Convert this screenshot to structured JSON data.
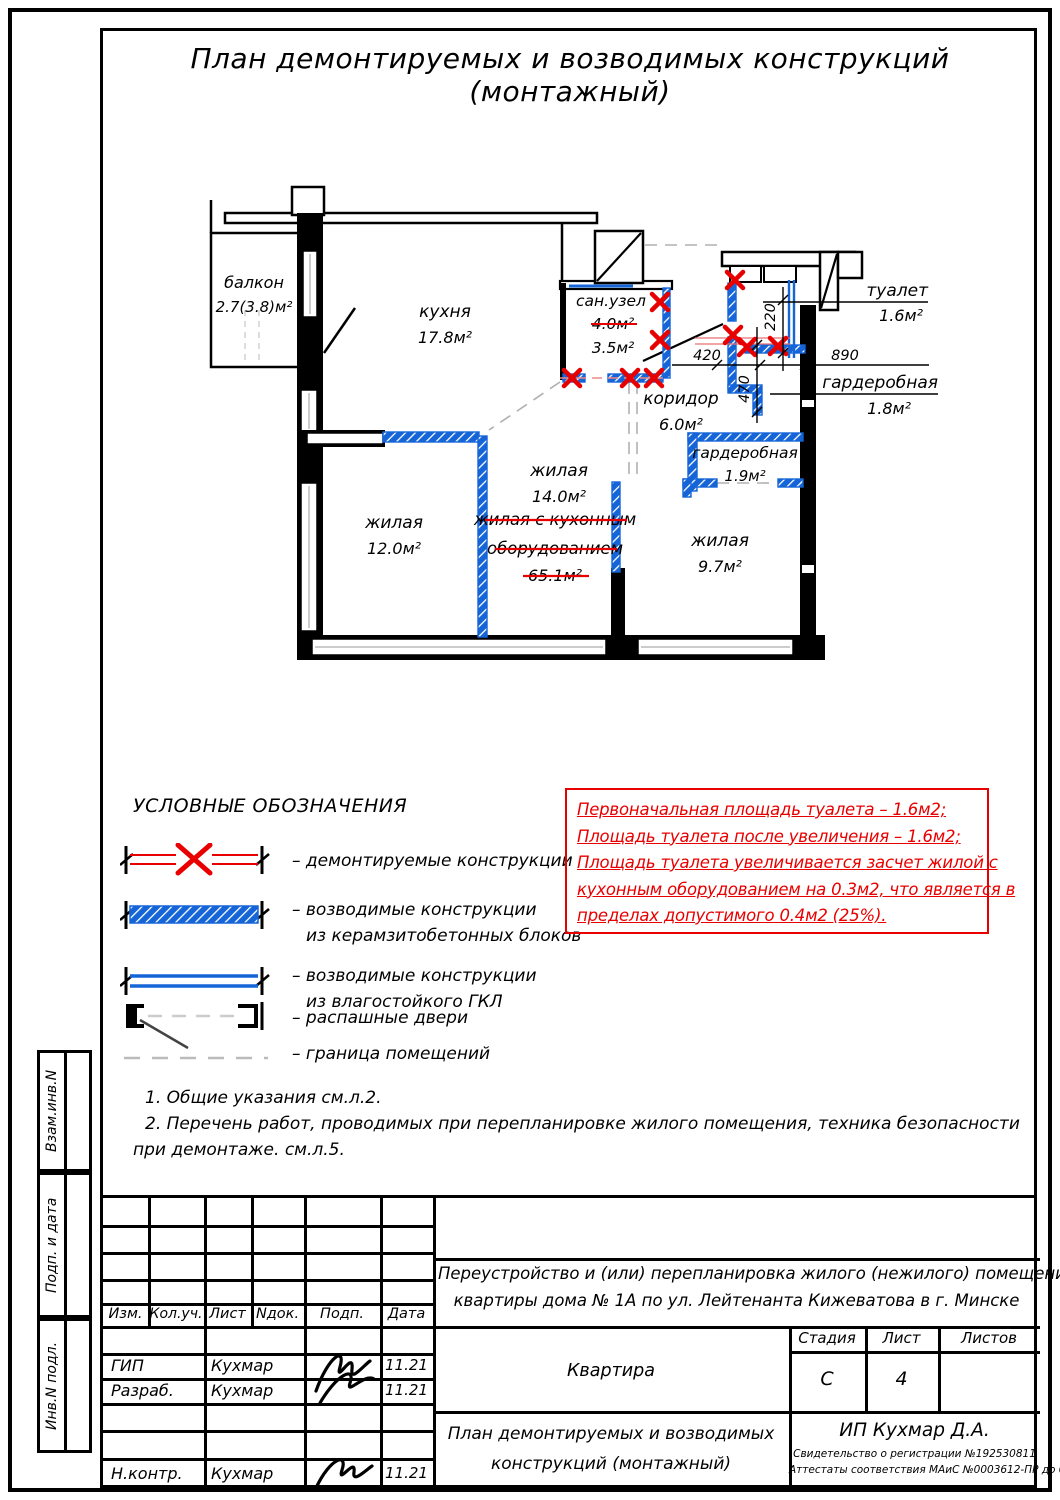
{
  "sheet_title": "План демонтируемых и возводимых конструкций (монтажный)",
  "plan": {
    "rooms": {
      "balcony": {
        "name": "балкон",
        "area": "2.7(3.8)м²"
      },
      "kitchen": {
        "name": "кухня",
        "area": "17.8м²"
      },
      "sanuzel": {
        "name": "сан.узел",
        "area_old": "4.0м²",
        "area_new": "3.5м²"
      },
      "corridor": {
        "name": "коридор",
        "area": "6.0м²"
      },
      "toilet": {
        "name": "туалет",
        "area": "1.6м²"
      },
      "wardrobe1": {
        "name": "гардеробная",
        "area": "1.8м²"
      },
      "wardrobe2": {
        "name": "гардеробная",
        "area": "1.9м²"
      },
      "living14": {
        "name": "жилая",
        "area": "14.0м²"
      },
      "living12": {
        "name": "жилая",
        "area": "12.0м²"
      },
      "living97": {
        "name": "жилая",
        "area": "9.7м²"
      },
      "living_struck": {
        "line1": "жилая с кухонным",
        "line2": "оборудованием",
        "line3": "65.1м²"
      }
    },
    "dims": {
      "d420": "420",
      "d220": "220",
      "d890": "890",
      "d470": "470"
    },
    "colors": {
      "new_wall_blue": "#1565d8",
      "demolition_red": "#e80000"
    }
  },
  "legend": {
    "heading": "УСЛОВНЫЕ ОБОЗНАЧЕНИЯ",
    "items": [
      {
        "label": "– демонтируемые конструкции",
        "label2": ""
      },
      {
        "label": "– возводимые конструкции",
        "label2": "из керамзитобетонных блоков"
      },
      {
        "label": "– возводимые конструкции",
        "label2": "из влагостойкого ГКЛ"
      },
      {
        "label": "– распашные двери",
        "label2": ""
      },
      {
        "label": "– граница помещений",
        "label2": ""
      }
    ]
  },
  "red_note": {
    "lines": [
      "Первоначальная площадь туалета – 1.6м2;",
      "Площадь туалета после увеличения – 1.6м2;",
      "Площадь туалета увеличивается засчет жилой с",
      "кухонным оборудованием на 0.3м2, что является в",
      "пределах допустимого 0.4м2 (25%)."
    ]
  },
  "notes": [
    "1. Общие указания см.л.2.",
    "2. Перечень работ, проводимых при перепланировке жилого помещения, техника безопасности",
    "при демонтаже. см.л.5."
  ],
  "stamp": {
    "headers": {
      "izm": "Изм.",
      "kol": "Кол.уч.",
      "list": "Лист",
      "ndok": "Nдок.",
      "podp": "Подп.",
      "data": "Дата"
    },
    "rows": [
      {
        "role": "ГИП",
        "name": "Кухмар",
        "date": "11.21"
      },
      {
        "role": "Разраб.",
        "name": "Кухмар",
        "date": "11.21"
      },
      {
        "role": "Н.контр.",
        "name": "Кухмар",
        "date": "11.21"
      }
    ],
    "project_line1": "Переустройство и (или) перепланировка жилого (нежилого) помещения",
    "project_line2": "квартиры дома № 1А по ул. Лейтенанта Кижеватова в г. Минске",
    "object_name": "Квартира",
    "stage_header": "Стадия",
    "sheet_header": "Лист",
    "sheets_header": "Листов",
    "stage_value": "С",
    "sheet_value": "4",
    "sheets_value": "",
    "doc_title_line1": "План демонтируемых и возводимых",
    "doc_title_line2": "конструкций (монтажный)",
    "firm_name": "ИП Кухмар Д.А.",
    "firm_cert1": "Свидетельство о регистрации №192530811",
    "firm_cert2": "Аттестаты соответствия МАиС №0003612-ПР до 09.04.2026"
  },
  "side_column": {
    "labels": [
      "Взам.инв.N",
      "Подп. и дата",
      "Инв.N подл."
    ]
  }
}
